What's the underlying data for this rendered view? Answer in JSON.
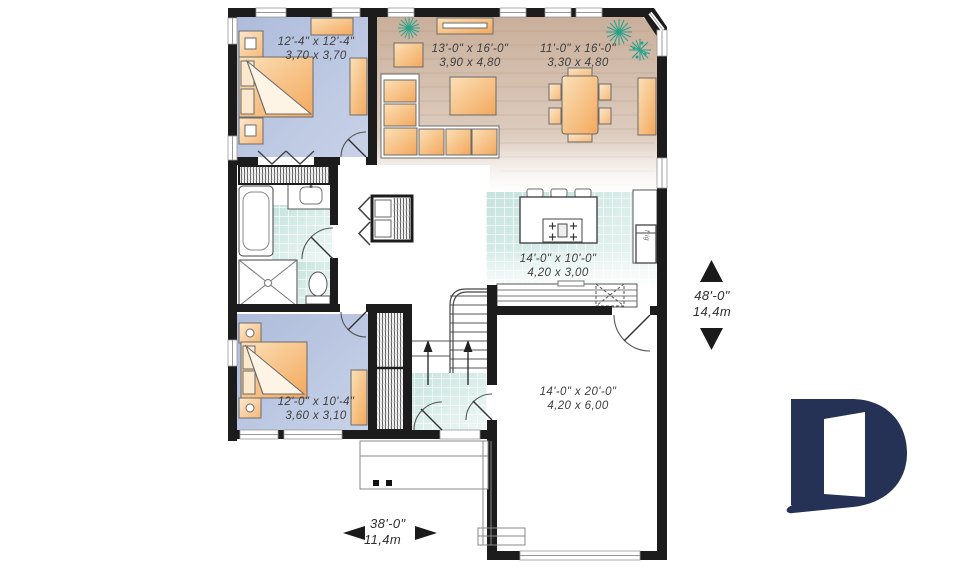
{
  "plan_type": "floor-plan",
  "rooms": {
    "bedroom1": {
      "imperial": "12'-4\" x 12'-4\"",
      "metric": "3,70 x 3,70"
    },
    "living": {
      "imperial": "13'-0\" x 16'-0\"",
      "metric": "3,90 x 4,80"
    },
    "dining": {
      "imperial": "11'-0\" x 16'-0\"",
      "metric": "3,30 x 4,80"
    },
    "kitchen": {
      "imperial": "14'-0\" x 10'-0\"",
      "metric": "4,20 x 3,00"
    },
    "bedroom2": {
      "imperial": "12'-0\" x 10'-4\"",
      "metric": "3,60 x 3,10"
    },
    "garage": {
      "imperial": "14'-0\" x 20'-0\"",
      "metric": "4,20 x 6,00"
    }
  },
  "dimensions": {
    "depth": {
      "imperial": "48'-0\"",
      "metric": "14,4m"
    },
    "width": {
      "imperial": "38'-0\"",
      "metric": "11,4m"
    }
  },
  "labels": {
    "fridge": "frig"
  },
  "colors": {
    "wall": "#1c1c1c",
    "bedroom_floor": "#b6c2dd",
    "wood_floor": "#cbb19d",
    "tile": "#cfe7e2",
    "furniture_orange": "#f5ab5e",
    "plant_teal": "#25a28b",
    "logo_navy": "#263156",
    "text": "#3e3e3e"
  }
}
